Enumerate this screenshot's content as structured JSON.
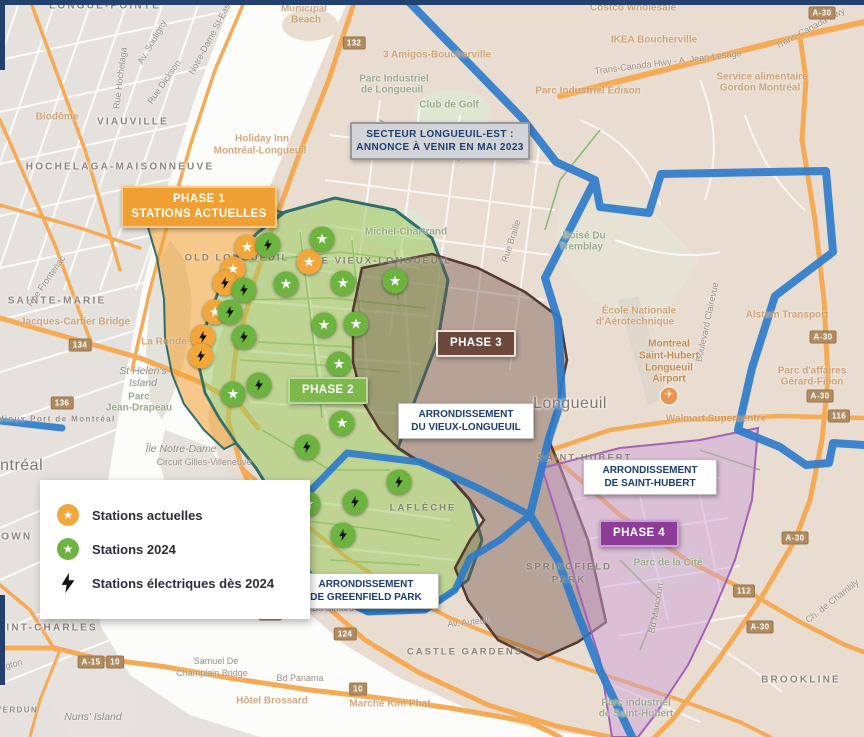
{
  "palette": {
    "phase1_orange": "#f0a033",
    "phase2_green": "#7cb84c",
    "phase3_brown": "#6b4a3d",
    "phase4_purple": "#8d3d98",
    "boundary_blue": "#2e7ccb",
    "callout_text_navy": "#1c3e6e",
    "marker_orange": "#f1a73b",
    "marker_green": "#6db33f"
  },
  "legend": {
    "items": [
      {
        "kind": "star",
        "color": "#f1a73b",
        "label": "Stations actuelles"
      },
      {
        "kind": "star",
        "color": "#6db33f",
        "label": "Stations 2024"
      },
      {
        "kind": "bolt",
        "color": "#111111",
        "label": "Stations électriques dès 2024"
      }
    ]
  },
  "callouts": {
    "secteur": {
      "line1": "SECTEUR LONGUEUIL-EST :",
      "line2": "ANNONCE À VENIR EN MAI 2023"
    },
    "phase1": {
      "line1": "PHASE 1",
      "line2": "STATIONS ACTUELLES"
    },
    "phase2": {
      "label": "PHASE 2"
    },
    "phase3": {
      "label": "PHASE 3"
    },
    "phase4": {
      "label": "PHASE 4"
    },
    "arr_vieux": {
      "line1": "ARRONDISSEMENT",
      "line2": "DU VIEUX-LONGUEUIL"
    },
    "arr_sthubert": {
      "line1": "ARRONDISSEMENT",
      "line2": "DE SAINT-HUBERT"
    },
    "arr_greenfield": {
      "line1": "ARRONDISSEMENT",
      "line2": "DE GREENFIELD PARK"
    }
  },
  "markers": [
    {
      "k": "star",
      "c": "orange",
      "x": 247,
      "y": 247
    },
    {
      "k": "star",
      "c": "orange",
      "x": 233,
      "y": 269
    },
    {
      "k": "star",
      "c": "orange",
      "x": 309,
      "y": 262
    },
    {
      "k": "star",
      "c": "orange",
      "x": 215,
      "y": 312
    },
    {
      "k": "bolt",
      "c": "orange",
      "x": 225,
      "y": 283
    },
    {
      "k": "bolt",
      "c": "orange",
      "x": 203,
      "y": 337
    },
    {
      "k": "bolt",
      "c": "orange",
      "x": 201,
      "y": 356
    },
    {
      "k": "star",
      "c": "green",
      "x": 322,
      "y": 239
    },
    {
      "k": "star",
      "c": "green",
      "x": 286,
      "y": 284
    },
    {
      "k": "star",
      "c": "green",
      "x": 343,
      "y": 283
    },
    {
      "k": "star",
      "c": "green",
      "x": 395,
      "y": 281
    },
    {
      "k": "star",
      "c": "green",
      "x": 324,
      "y": 325
    },
    {
      "k": "star",
      "c": "green",
      "x": 356,
      "y": 324
    },
    {
      "k": "star",
      "c": "green",
      "x": 339,
      "y": 364
    },
    {
      "k": "star",
      "c": "green",
      "x": 233,
      "y": 394
    },
    {
      "k": "star",
      "c": "green",
      "x": 342,
      "y": 423
    },
    {
      "k": "star",
      "c": "green",
      "x": 308,
      "y": 504
    },
    {
      "k": "bolt",
      "c": "green",
      "x": 268,
      "y": 245
    },
    {
      "k": "bolt",
      "c": "green",
      "x": 244,
      "y": 290
    },
    {
      "k": "bolt",
      "c": "green",
      "x": 230,
      "y": 312
    },
    {
      "k": "bolt",
      "c": "green",
      "x": 244,
      "y": 337
    },
    {
      "k": "bolt",
      "c": "green",
      "x": 259,
      "y": 385
    },
    {
      "k": "bolt",
      "c": "green",
      "x": 307,
      "y": 447
    },
    {
      "k": "bolt",
      "c": "green",
      "x": 399,
      "y": 482
    },
    {
      "k": "bolt",
      "c": "green",
      "x": 355,
      "y": 502
    },
    {
      "k": "bolt",
      "c": "green",
      "x": 343,
      "y": 535
    }
  ],
  "shields": [
    {
      "t": "132",
      "x": 354,
      "y": 43
    },
    {
      "t": "A-30",
      "x": 822,
      "y": 13
    },
    {
      "t": "A-30",
      "x": 823,
      "y": 337
    },
    {
      "t": "A-30",
      "x": 820,
      "y": 396
    },
    {
      "t": "116",
      "x": 839,
      "y": 416
    },
    {
      "t": "112",
      "x": 744,
      "y": 591
    },
    {
      "t": "A-30",
      "x": 760,
      "y": 627
    },
    {
      "t": "A-30",
      "x": 795,
      "y": 538
    },
    {
      "t": "134",
      "x": 80,
      "y": 345
    },
    {
      "t": "136",
      "x": 62,
      "y": 403
    },
    {
      "t": "124",
      "x": 345,
      "y": 634
    },
    {
      "t": "132",
      "x": 270,
      "y": 614
    },
    {
      "t": "A-15",
      "x": 91,
      "y": 662
    },
    {
      "t": "10",
      "x": 115,
      "y": 662
    },
    {
      "t": "10",
      "x": 358,
      "y": 689
    }
  ],
  "map_labels": [
    {
      "t": "LONGUE-POINTE",
      "x": 105,
      "y": 6,
      "c": "area"
    },
    {
      "t": "VIAUVILLE",
      "x": 133,
      "y": 122,
      "c": "area"
    },
    {
      "t": "HOCHELAGA-MAISONNEUVE",
      "x": 120,
      "y": 167,
      "c": "area"
    },
    {
      "t": "SAINTE-MARIE",
      "x": 57,
      "y": 301,
      "c": "area"
    },
    {
      "t": "POINTE-SAINT-CHARLES",
      "x": 15,
      "y": 628,
      "c": "area"
    },
    {
      "t": "GRIFFINTOWN",
      "x": -15,
      "y": 537,
      "c": "area"
    },
    {
      "t": "VERDUN",
      "x": 17,
      "y": 710,
      "c": "areasm"
    },
    {
      "t": "BROOKLINE",
      "x": 801,
      "y": 680,
      "c": "area"
    },
    {
      "t": "CASTLE GARDENS",
      "x": 465,
      "y": 652,
      "c": "hood"
    },
    {
      "t": "SPRINGFIELD",
      "x": 569,
      "y": 567,
      "c": "hood"
    },
    {
      "t": "PARK",
      "x": 569,
      "y": 580,
      "c": "hood"
    },
    {
      "t": "LAFLÈCHE",
      "x": 423,
      "y": 508,
      "c": "hood"
    },
    {
      "t": "SAINT-HUBERT",
      "x": 585,
      "y": 458,
      "c": "hood"
    },
    {
      "t": "OLD LONGUEUIL",
      "x": 237,
      "y": 258,
      "c": "hood"
    },
    {
      "t": "LE VIEUX-LONGUEUIL",
      "x": 383,
      "y": 261,
      "c": "hood"
    },
    {
      "t": "Montréal",
      "x": 10,
      "y": 466,
      "c": "big"
    },
    {
      "t": "Longueuil",
      "x": 570,
      "y": 404,
      "c": "big"
    },
    {
      "t": "St Helen's",
      "x": 143,
      "y": 371,
      "c": "water"
    },
    {
      "t": "Island",
      "x": 143,
      "y": 383,
      "c": "water"
    },
    {
      "t": "Île Notre-Dame",
      "x": 181,
      "y": 449,
      "c": "water"
    },
    {
      "t": "Nuns' Island",
      "x": 93,
      "y": 717,
      "c": "water"
    },
    {
      "t": "Parc",
      "x": 139,
      "y": 397,
      "c": "park"
    },
    {
      "t": "Jean-Drapeau",
      "x": 139,
      "y": 408,
      "c": "park"
    },
    {
      "t": "Circuit Gilles-Villeneuve",
      "x": 204,
      "y": 462,
      "c": "road"
    },
    {
      "t": "La Ronde",
      "x": 164,
      "y": 342,
      "c": "faint"
    },
    {
      "t": "Biodôme",
      "x": 57,
      "y": 117,
      "c": "faint"
    },
    {
      "t": "Holiday Inn",
      "x": 262,
      "y": 139,
      "c": "faint"
    },
    {
      "t": "Montréal-Longueuil",
      "x": 260,
      "y": 151,
      "c": "faint"
    },
    {
      "t": "Municipal",
      "x": 304,
      "y": 9,
      "c": "faint"
    },
    {
      "t": "Beach",
      "x": 306,
      "y": 20,
      "c": "faint"
    },
    {
      "t": "3 Amigos-Boucherville",
      "x": 437,
      "y": 55,
      "c": "faint"
    },
    {
      "t": "Club de Golf",
      "x": 449,
      "y": 105,
      "c": "park"
    },
    {
      "t": "Parc Industriel",
      "x": 394,
      "y": 79,
      "c": "park"
    },
    {
      "t": "de Longueuil",
      "x": 392,
      "y": 90,
      "c": "park"
    },
    {
      "t": "Costco Wholesale",
      "x": 633,
      "y": 8,
      "c": "faint"
    },
    {
      "t": "IKEA Boucherville",
      "x": 654,
      "y": 40,
      "c": "faint"
    },
    {
      "t": "Service alimentaire",
      "x": 762,
      "y": 77,
      "c": "faint"
    },
    {
      "t": "Gordon Montréal",
      "x": 760,
      "y": 88,
      "c": "faint"
    },
    {
      "t": "Parc Industriel Édison",
      "x": 588,
      "y": 91,
      "c": "faint"
    },
    {
      "t": "École Nationale",
      "x": 639,
      "y": 311,
      "c": "faint"
    },
    {
      "t": "d'Aérotechnique",
      "x": 635,
      "y": 322,
      "c": "faint"
    },
    {
      "t": "Montreal",
      "x": 669,
      "y": 344,
      "c": "poi"
    },
    {
      "t": "Saint-Hubert",
      "x": 669,
      "y": 356,
      "c": "poi"
    },
    {
      "t": "Longueuil",
      "x": 669,
      "y": 368,
      "c": "poi"
    },
    {
      "t": "Airport",
      "x": 669,
      "y": 379,
      "c": "poi"
    },
    {
      "t": "✈",
      "x": 669,
      "y": 396,
      "c": "pin"
    },
    {
      "t": "Alstom Transport",
      "x": 787,
      "y": 315,
      "c": "faint"
    },
    {
      "t": "Parc d'affaires",
      "x": 812,
      "y": 371,
      "c": "faint"
    },
    {
      "t": "Gérard-Filion",
      "x": 812,
      "y": 382,
      "c": "faint"
    },
    {
      "t": "Walmart Supercentre",
      "x": 716,
      "y": 419,
      "c": "faint"
    },
    {
      "t": "Hôtel Brossard",
      "x": 272,
      "y": 701,
      "c": "faint"
    },
    {
      "t": "Marché Kim Phat",
      "x": 390,
      "y": 704,
      "c": "faint"
    },
    {
      "t": "Samuel De",
      "x": 216,
      "y": 661,
      "c": "road"
    },
    {
      "t": "Champlain Bridge",
      "x": 212,
      "y": 673,
      "c": "road"
    },
    {
      "t": "Jacques-Cartier Bridge",
      "x": 75,
      "y": 322,
      "c": "faint"
    },
    {
      "t": "Vieux Port de Montréal",
      "x": 57,
      "y": 419,
      "c": "areasm"
    },
    {
      "t": "Boisé Du",
      "x": 584,
      "y": 236,
      "c": "park"
    },
    {
      "t": "Tremblay",
      "x": 581,
      "y": 247,
      "c": "park"
    },
    {
      "t": "Michel-Chartrand",
      "x": 406,
      "y": 232,
      "c": "park"
    },
    {
      "t": "Parc de la Cité",
      "x": 668,
      "y": 563,
      "c": "park"
    },
    {
      "t": "Parc industriel",
      "x": 636,
      "y": 703,
      "c": "park"
    },
    {
      "t": "de Saint-Hubert",
      "x": 636,
      "y": 714,
      "c": "park"
    },
    {
      "t": "Lambert",
      "x": 268,
      "y": 537,
      "c": "areasm"
    },
    {
      "t": "Rue Hochelaga",
      "x": 120,
      "y": 78,
      "c": "road",
      "r": -83
    },
    {
      "t": "Av. Souligny",
      "x": 152,
      "y": 42,
      "c": "road",
      "r": -60
    },
    {
      "t": "Rue Dickson",
      "x": 164,
      "y": 82,
      "c": "road",
      "r": -55
    },
    {
      "t": "Notre-Dame St-East",
      "x": 210,
      "y": 38,
      "c": "road",
      "r": -62
    },
    {
      "t": "Rue Frontenac",
      "x": 46,
      "y": 281,
      "c": "road",
      "r": -55
    },
    {
      "t": "Rue Braille",
      "x": 511,
      "y": 241,
      "c": "road",
      "r": -72
    },
    {
      "t": "Boulevard Clairevue",
      "x": 707,
      "y": 322,
      "c": "road",
      "r": -78
    },
    {
      "t": "Ch. de Chambly",
      "x": 832,
      "y": 601,
      "c": "road",
      "r": -38
    },
    {
      "t": "Bd Maricourt",
      "x": 656,
      "y": 608,
      "c": "road",
      "r": -80
    },
    {
      "t": "Bd Simard",
      "x": 333,
      "y": 608,
      "c": "road"
    },
    {
      "t": "Av. Auteuil",
      "x": 468,
      "y": 622,
      "c": "road",
      "r": -6
    },
    {
      "t": "Bd Panama",
      "x": 300,
      "y": 678,
      "c": "road"
    },
    {
      "t": "Trans-Canada Hwy - A. Jean-Lesage",
      "x": 668,
      "y": 62,
      "c": "road",
      "r": -7
    },
    {
      "t": "Trans-Canada Hwy",
      "x": 810,
      "y": 28,
      "c": "road",
      "r": -28
    },
    {
      "t": "Wellington",
      "x": 2,
      "y": 667,
      "c": "road",
      "r": -15
    }
  ]
}
